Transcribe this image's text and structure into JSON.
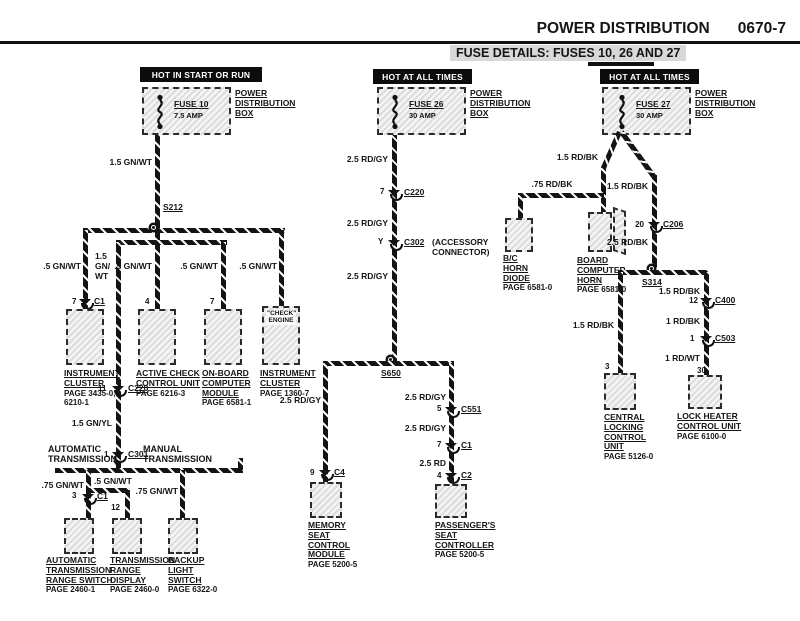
{
  "header": {
    "title": "POWER DISTRIBUTION",
    "page_code": "0670-7",
    "subtitle": "FUSE DETAILS: FUSES 10, 26 AND 27"
  },
  "colors": {
    "ink": "#111111",
    "paper": "#ffffff",
    "banner_bg": "#0c0c0c"
  },
  "pdb_label": [
    "POWER",
    "DISTRIBUTION",
    "BOX"
  ],
  "banners": {
    "left": "HOT IN START OR RUN",
    "middle": "HOT AT ALL TIMES",
    "right": "HOT AT ALL TIMES"
  },
  "fuses": {
    "f10": {
      "name": "FUSE 10",
      "rating": "7.5 AMP"
    },
    "f26": {
      "name": "FUSE 26",
      "rating": "30 AMP"
    },
    "f27": {
      "name": "FUSE 27",
      "rating": "30 AMP"
    }
  },
  "left": {
    "wire_fuse": "1.5 GN/WT",
    "splice": "S212",
    "w1": ".5 GN/WT",
    "w2_lines": [
      "1.5",
      "GN/",
      "WT"
    ],
    "w3": ".5 GN/WT",
    "w4": ".5 GN/WT",
    "w5": ".5 GN/WT",
    "b1_pin": "7",
    "b1_conn": "C1",
    "b2_pin": "4",
    "b3_pin": "7",
    "b4_inside": [
      "\"CHECK\"",
      "ENGINE"
    ],
    "b1_name": [
      "INSTRUMENT",
      "CLUSTER"
    ],
    "b1_page": [
      "PAGE 3435-0,",
      "6210-1"
    ],
    "b2_name": [
      "ACTIVE CHECK",
      "CONTROL UNIT"
    ],
    "b2_page": [
      "PAGE 6216-3"
    ],
    "b3_name": [
      "ON-BOARD",
      "COMPUTER",
      "MODULE"
    ],
    "b3_page": [
      "PAGE 6581-1"
    ],
    "b4_name": [
      "INSTRUMENT",
      "CLUSTER"
    ],
    "b4_page": [
      "PAGE 1360-7"
    ],
    "c220_pin": "11",
    "c220": "C220",
    "wire_gnyl": "1.5 GN/YL",
    "c301_pin": "1",
    "c301": "C301",
    "auto_hdr": [
      "AUTOMATIC",
      "TRANSMISSION"
    ],
    "manual_hdr": [
      "MANUAL",
      "TRANSMISSION"
    ],
    "w_auto": ".75 GN/WT",
    "w_range": ".5 GN/WT",
    "w_backup": ".75 GN/WT",
    "atrs_pin": "3",
    "atrs_conn": "C1",
    "trd_pin": "12",
    "b5_name": [
      "AUTOMATIC",
      "TRANSMISSION",
      "RANGE SWITCH"
    ],
    "b5_page": [
      "PAGE 2460-1"
    ],
    "b6_name": [
      "TRANSMISSION",
      "RANGE",
      "DISPLAY"
    ],
    "b6_page": [
      "PAGE 2460-0"
    ],
    "b7_name": [
      "BACKUP",
      "LIGHT",
      "SWITCH"
    ],
    "b7_page": [
      "PAGE 6322-0"
    ]
  },
  "middle": {
    "w1": "2.5 RD/GY",
    "c220_pin": "7",
    "c220": "C220",
    "w2": "2.5 RD/GY",
    "c302_pin": "Y",
    "c302": "C302",
    "c302_note": [
      "(ACCESSORY",
      "CONNECTOR)"
    ],
    "w3": "2.5 RD/GY",
    "splice": "S650",
    "wl": "2.5 RD/GY",
    "c4_pin": "9",
    "c4": "C4",
    "mem_name": [
      "MEMORY",
      "SEAT",
      "CONTROL",
      "MODULE"
    ],
    "mem_page": [
      "PAGE 5200-5"
    ],
    "wr1": "2.5 RD/GY",
    "c551_pin": "5",
    "c551": "C551",
    "wr2": "2.5 RD/GY",
    "c1_pin": "7",
    "c1": "C1",
    "wr3": "2.5 RD",
    "c2_pin": "4",
    "c2": "C2",
    "pass_name": [
      "PASSENGER'S",
      "SEAT",
      "CONTROLLER"
    ],
    "pass_page": [
      "PAGE 5200-5"
    ]
  },
  "right": {
    "w_left": "1.5 RD/BK",
    "w_right": "1.5 RD/BK",
    "w_diode": ".75 RD/BK",
    "diode_name": [
      "B/C",
      "HORN",
      "DIODE"
    ],
    "diode_page": [
      "PAGE 6581-0"
    ],
    "horn_name": [
      "BOARD",
      "COMPUTER",
      "HORN"
    ],
    "horn_page": [
      "PAGE 6581-0"
    ],
    "c206_pin": "20",
    "c206": "C206",
    "w_mid": "2.5 RD/BK",
    "splice": "S314",
    "w_cl": "1.5 RD/BK",
    "cl_pin": "3",
    "cl_name": [
      "CENTRAL",
      "LOCKING",
      "CONTROL",
      "UNIT"
    ],
    "cl_page": [
      "PAGE 5126-0"
    ],
    "w_lh1": "1.5 RD/BK",
    "c400_pin": "12",
    "c400": "C400",
    "w_lh2": "1 RD/BK",
    "c503_pin": "1",
    "c503": "C503",
    "w_lh3": "1 RD/WT",
    "lh_pin": "30",
    "lh_name": [
      "LOCK HEATER",
      "CONTROL UNIT"
    ],
    "lh_page": [
      "PAGE 6100-0"
    ]
  }
}
